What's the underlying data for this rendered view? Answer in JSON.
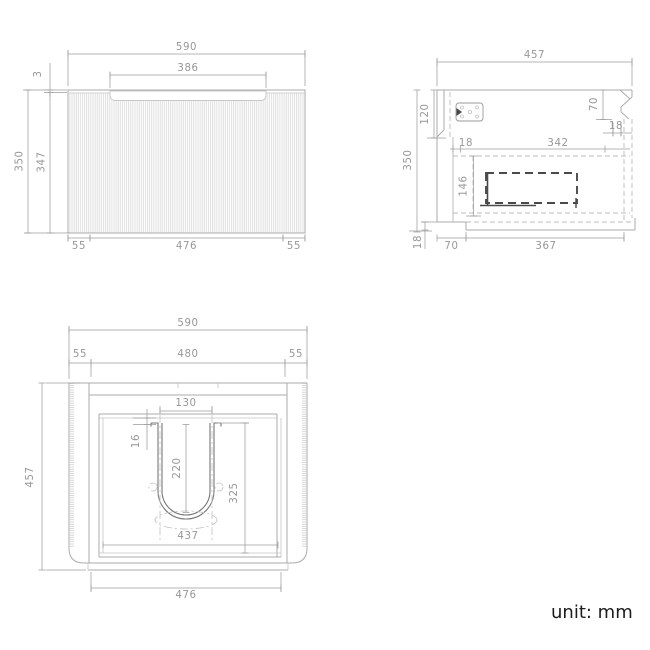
{
  "unit_label": "unit: mm",
  "front_view": {
    "overall_width": "590",
    "recess_width": "386",
    "top_edge": "3",
    "overall_height": "350",
    "panel_height": "347",
    "left_side": "55",
    "center_width": "476",
    "right_side": "55"
  },
  "side_view": {
    "overall_depth": "457",
    "rail_drop": "120",
    "overall_height": "350",
    "top_recess_height": "70",
    "recess_setback": "18",
    "back_gap": "18",
    "drawer_depth": "342",
    "drawer_height": "146",
    "bottom_thickness": "18",
    "bottom_back_offset": "70",
    "bottom_length": "367"
  },
  "plan_view": {
    "overall_width": "590",
    "left_side": "55",
    "opening_width": "480",
    "right_side": "55",
    "overall_depth": "457",
    "cutout_width": "130",
    "cutout_offset": "16",
    "cutout_depth": "220",
    "inner_depth": "325",
    "inner_width": "437",
    "front_width": "476"
  }
}
